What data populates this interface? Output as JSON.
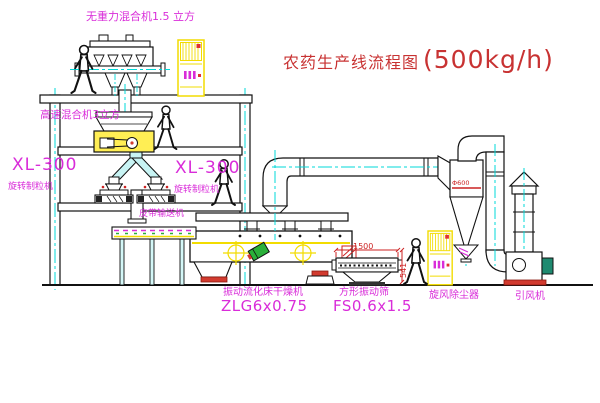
{
  "title": {
    "name": "农药生产线流程图",
    "capacity": "(500kg/h)"
  },
  "equipment_labels": {
    "zero_gravity_mixer": "无重力混合机1.5 立方",
    "high_speed_mixer": "高速混合机3立方",
    "granulator_left": {
      "model": "XL-300",
      "name": "旋转制粒机"
    },
    "granulator_right": {
      "model": "XL-300",
      "name": "旋转制粒机"
    },
    "belt_conveyor": "皮带输送机",
    "fluid_bed_dryer": {
      "name": "振动流化床干燥机",
      "model": "ZLG6x0.75"
    },
    "vibrating_sieve": {
      "name": "方形振动筛",
      "model": "FS0.6x1.5"
    },
    "cyclone_dust_collector": "旋风除尘器",
    "induced_draft_fan": "引风机"
  },
  "annotations": {
    "sieve_length": "1500",
    "sieve_height": "541",
    "cyclone_marking": "Φ600"
  },
  "colors": {
    "label_magenta": "#d92cd9",
    "title_red": "#c83232",
    "centerline_cyan": "#00d8d8",
    "highlight_yellow": "#f2dc00",
    "line_black": "#111111"
  }
}
